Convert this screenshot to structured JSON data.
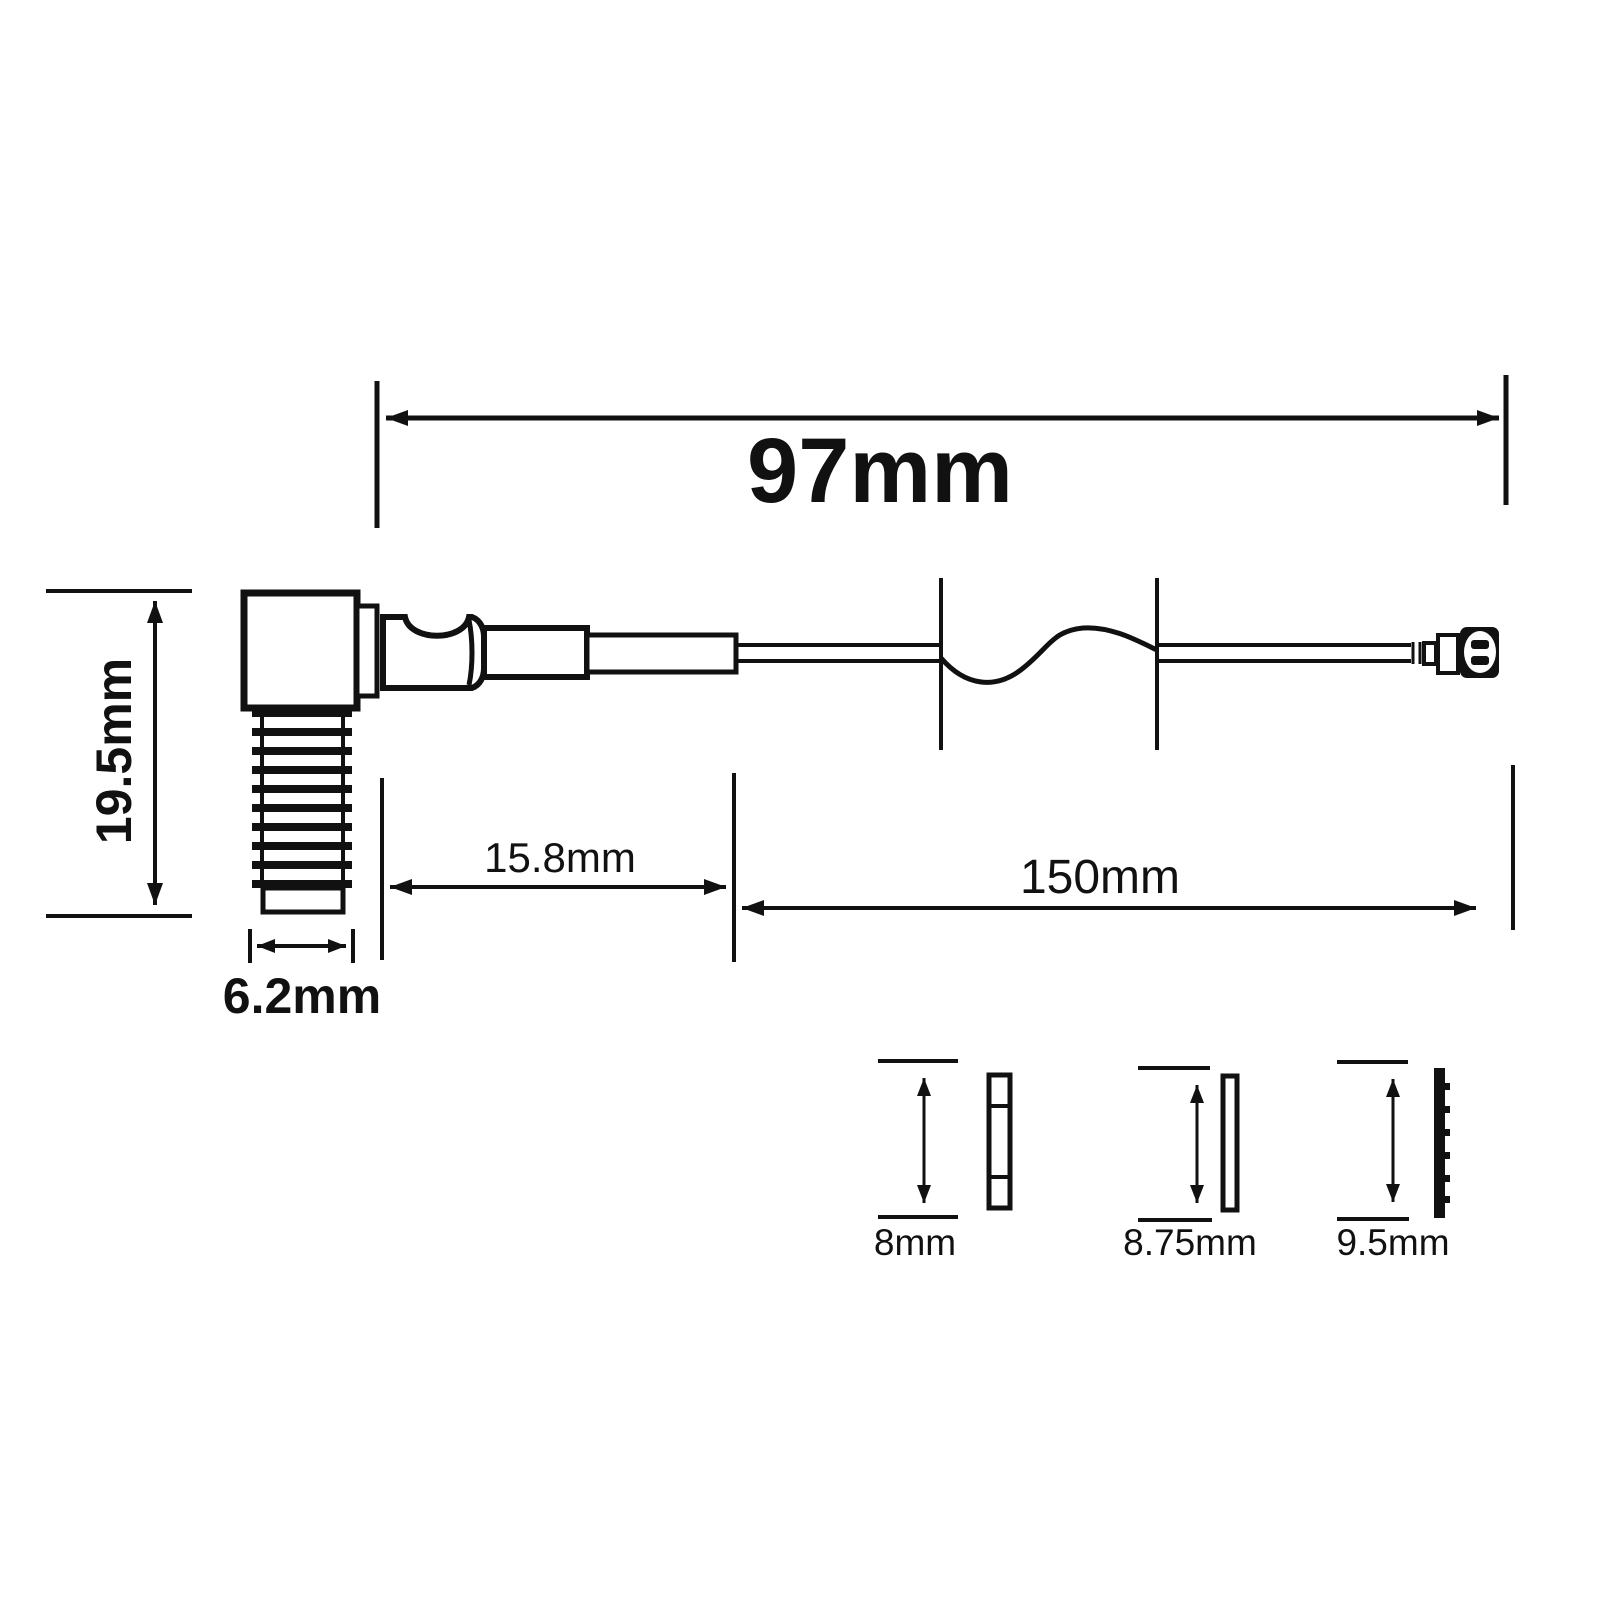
{
  "diagram": {
    "kind": "technical-dimension-drawing",
    "line_color": "#111111",
    "background_color": "#ffffff",
    "dimensions": {
      "overall_length": {
        "label": "97mm"
      },
      "connector_height": {
        "label": "19.5mm"
      },
      "thread_diameter": {
        "label": "6.2mm"
      },
      "body_length": {
        "label": "15.8mm"
      },
      "cable_length": {
        "label": "150mm"
      }
    },
    "small_parts": [
      {
        "label": "8mm"
      },
      {
        "label": "8.75mm"
      },
      {
        "label": "9.5mm"
      }
    ]
  }
}
